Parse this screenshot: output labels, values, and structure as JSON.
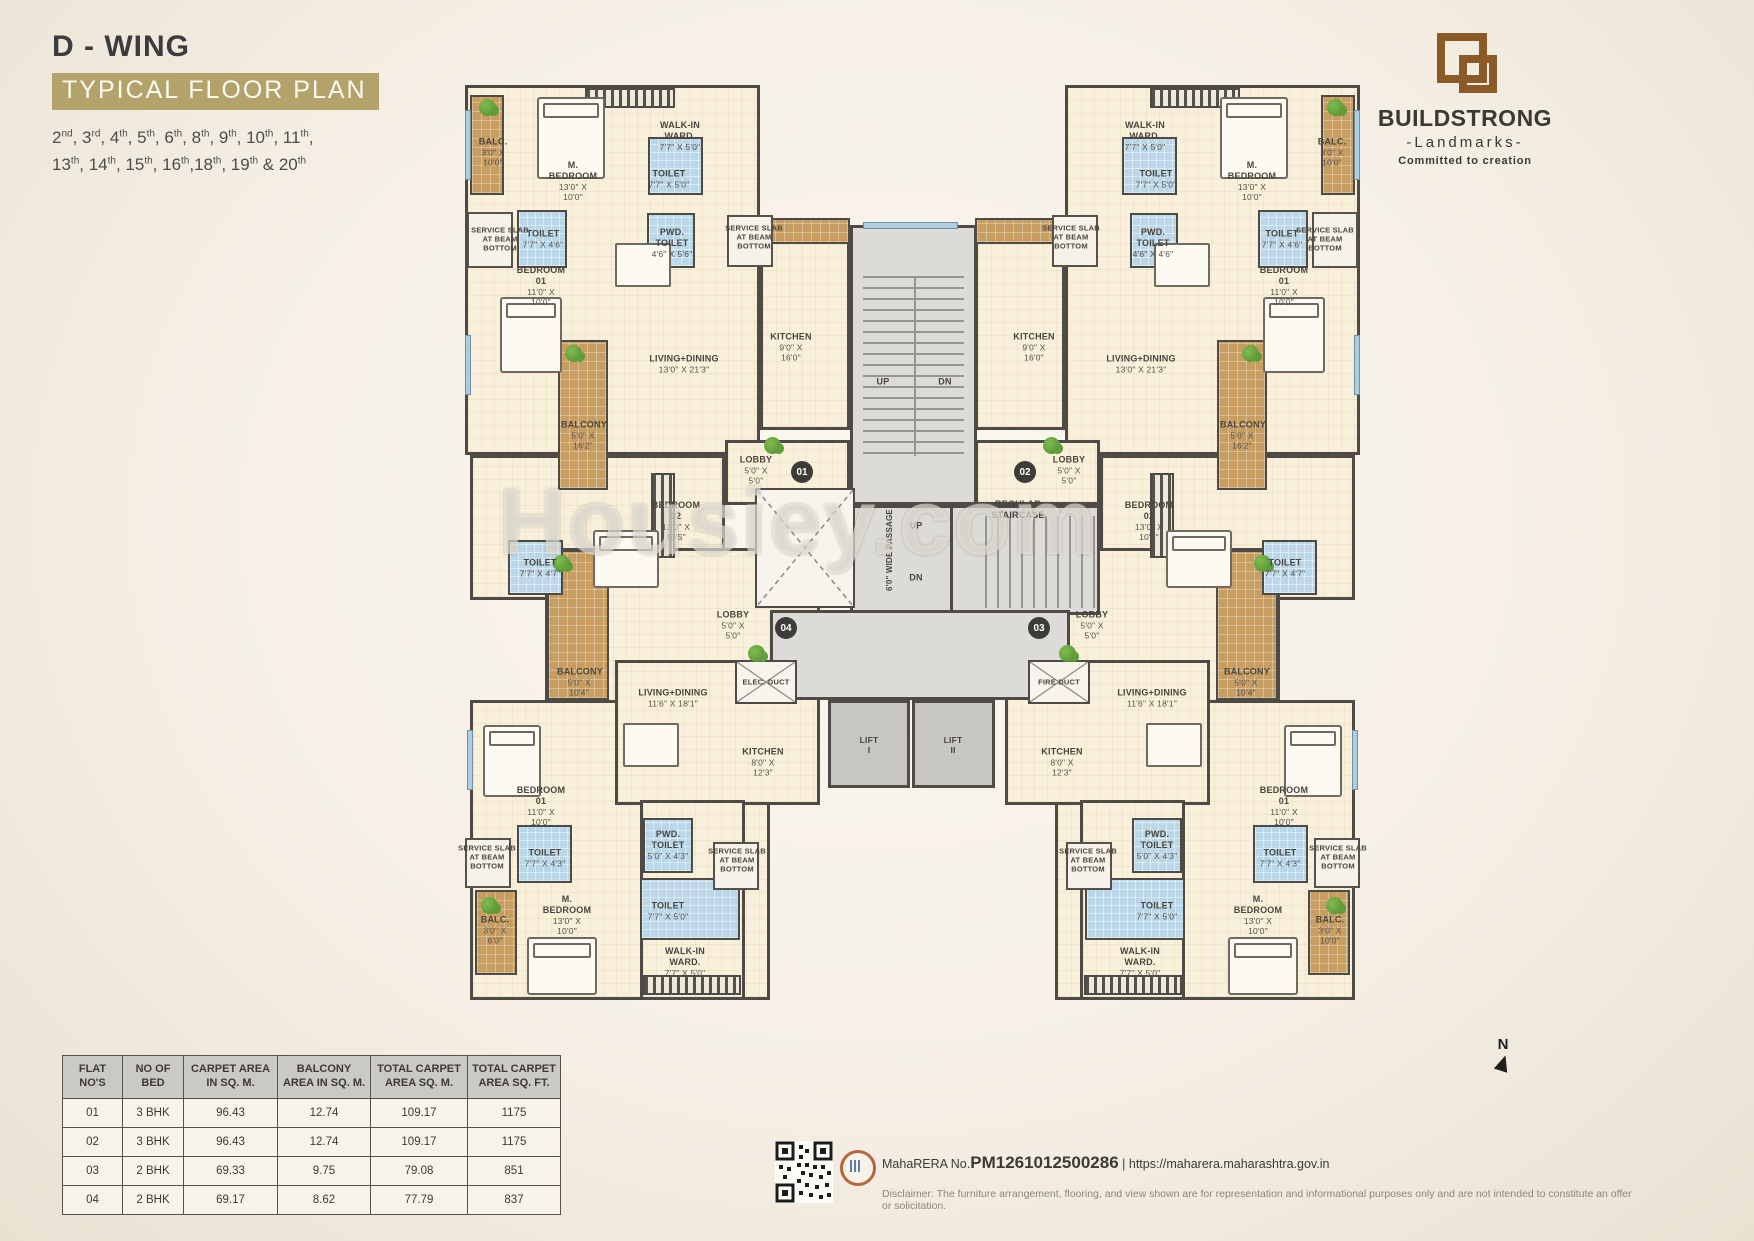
{
  "header": {
    "wing": "D - WING",
    "plan_type": "TYPICAL FLOOR PLAN",
    "floors_line1": "2nd, 3rd, 4th, 5th, 6th, 8th, 9th, 10th, 11th,",
    "floors_line2": "13th, 14th, 15th, 16th,18th, 19th & 20th"
  },
  "brand": {
    "name": "BUILDSTRONG",
    "sub": "-Landmarks-",
    "tagline": "Committed to creation"
  },
  "watermark": "Housiey.com",
  "compass": "N",
  "plan": {
    "labels": [
      {
        "t": "BALC.",
        "d": "3'0\" X 10'0\"",
        "x": 28,
        "y": 67,
        "w": 40
      },
      {
        "t": "M. BEDROOM",
        "d": "13'0\" X 10'0\"",
        "x": 108,
        "y": 96
      },
      {
        "t": "WALK-IN WARD.",
        "d": "7'7\" X 5'0\"",
        "x": 215,
        "y": 51,
        "w": 60
      },
      {
        "t": "TOILET",
        "d": "7'7\" X 5'0\"",
        "x": 204,
        "y": 94,
        "w": 44
      },
      {
        "t": "SERVICE SLAB AT BEAM BOTTOM",
        "x": 35,
        "y": 154,
        "w": 58,
        "s": 7.5
      },
      {
        "t": "TOILET",
        "d": "7'7\" X 4'6\"",
        "x": 78,
        "y": 154,
        "w": 44
      },
      {
        "t": "PWD. TOILET",
        "d": "4'6\" X 5'6\"",
        "x": 207,
        "y": 158,
        "w": 48
      },
      {
        "t": "SERVICE SLAB AT BEAM BOTTOM",
        "x": 289,
        "y": 152,
        "w": 58,
        "s": 7.5
      },
      {
        "t": "BEDROOM 01",
        "d": "11'0\" X 10'0\"",
        "x": 76,
        "y": 201
      },
      {
        "t": "LIVING+DINING",
        "d": "13'0\" X 21'3\"",
        "x": 219,
        "y": 279
      },
      {
        "t": "KITCHEN",
        "d": "9'0\" X 16'0\"",
        "x": 326,
        "y": 262
      },
      {
        "t": "BALCONY",
        "d": "5'0\" X 16'2\"",
        "x": 118,
        "y": 350,
        "w": 44
      },
      {
        "t": "LOBBY",
        "d": "5'0\" X 5'0\"",
        "x": 291,
        "y": 385
      },
      {
        "t": "BEDROOM 02",
        "d": "13'0\" X 10'5\"",
        "x": 211,
        "y": 436
      },
      {
        "t": "TOILET",
        "d": "7'7\" X 4'7\"",
        "x": 75,
        "y": 483,
        "w": 44
      },
      {
        "t": "BALC.",
        "d": "3'0\" X 10'0\"",
        "x": 867,
        "y": 67,
        "w": 40
      },
      {
        "t": "M. BEDROOM",
        "d": "13'0\" X 10'0\"",
        "x": 787,
        "y": 96
      },
      {
        "t": "WALK-IN WARD.",
        "d": "7'7\" X 5'0\"",
        "x": 680,
        "y": 51,
        "w": 60
      },
      {
        "t": "TOILET",
        "d": "7'7\" X 5'0\"",
        "x": 691,
        "y": 94,
        "w": 44
      },
      {
        "t": "SERVICE SLAB AT BEAM BOTTOM",
        "x": 860,
        "y": 154,
        "w": 58,
        "s": 7.5
      },
      {
        "t": "TOILET",
        "d": "7'7\" X 4'6\"",
        "x": 817,
        "y": 154,
        "w": 44
      },
      {
        "t": "PWD. TOILET",
        "d": "4'6\" X 4'6\"",
        "x": 688,
        "y": 158,
        "w": 48
      },
      {
        "t": "SERVICE SLAB AT BEAM BOTTOM",
        "x": 606,
        "y": 152,
        "w": 58,
        "s": 7.5
      },
      {
        "t": "BEDROOM 01",
        "d": "11'0\" X 10'0\"",
        "x": 819,
        "y": 201
      },
      {
        "t": "LIVING+DINING",
        "d": "13'0\" X 21'3\"",
        "x": 676,
        "y": 279
      },
      {
        "t": "KITCHEN",
        "d": "9'0\" X 16'0\"",
        "x": 569,
        "y": 262
      },
      {
        "t": "BALCONY",
        "d": "5'0\" X 16'2\"",
        "x": 777,
        "y": 350,
        "w": 44
      },
      {
        "t": "LOBBY",
        "d": "5'0\" X 5'0\"",
        "x": 604,
        "y": 385
      },
      {
        "t": "BEDROOM 02",
        "d": "13'0\" X 10'5\"",
        "x": 684,
        "y": 436
      },
      {
        "t": "TOILET",
        "d": "7'7\" X 4'7\"",
        "x": 820,
        "y": 483,
        "w": 44
      },
      {
        "t": "LOBBY",
        "d": "5'0\" X 5'0\"",
        "x": 268,
        "y": 540
      },
      {
        "t": "ELEC. DUCT",
        "x": 301,
        "y": 597,
        "w": 70,
        "s": 7.5
      },
      {
        "t": "LIVING+DINING",
        "d": "11'6\" X 18'1\"",
        "x": 208,
        "y": 613
      },
      {
        "t": "BALCONY",
        "d": "5'0\" X 10'4\"",
        "x": 114,
        "y": 597,
        "w": 44
      },
      {
        "t": "BEDROOM 01",
        "d": "11'0\" X 10'0\"",
        "x": 76,
        "y": 721
      },
      {
        "t": "SERVICE SLAB AT BEAM BOTTOM",
        "x": 22,
        "y": 772,
        "w": 58,
        "s": 7.5
      },
      {
        "t": "TOILET",
        "d": "7'7\" X 4'3\"",
        "x": 80,
        "y": 773,
        "w": 44
      },
      {
        "t": "PWD. TOILET",
        "d": "5'0\" X 4'3\"",
        "x": 203,
        "y": 760,
        "w": 48
      },
      {
        "t": "SERVICE SLAB AT BEAM BOTTOM",
        "x": 272,
        "y": 775,
        "w": 58,
        "s": 7.5
      },
      {
        "t": "KITCHEN",
        "d": "8'0\" X 12'3\"",
        "x": 298,
        "y": 677
      },
      {
        "t": "BALC.",
        "d": "3'0\" X 6'0\"",
        "x": 30,
        "y": 845,
        "w": 36
      },
      {
        "t": "M. BEDROOM",
        "d": "13'0\" X 10'0\"",
        "x": 102,
        "y": 830
      },
      {
        "t": "TOILET",
        "d": "7'7\" X 5'0\"",
        "x": 203,
        "y": 826,
        "w": 44
      },
      {
        "t": "WALK-IN WARD.",
        "d": "7'7\" X 5'0\"",
        "x": 220,
        "y": 877,
        "w": 62
      },
      {
        "t": "LOBBY",
        "d": "5'0\" X 5'0\"",
        "x": 627,
        "y": 540
      },
      {
        "t": "FIRE DUCT",
        "x": 594,
        "y": 597,
        "w": 70,
        "s": 7.5
      },
      {
        "t": "LIVING+DINING",
        "d": "11'6\" X 18'1\"",
        "x": 687,
        "y": 613
      },
      {
        "t": "BALCONY",
        "d": "5'0\" X 10'4\"",
        "x": 781,
        "y": 597,
        "w": 44
      },
      {
        "t": "BEDROOM 01",
        "d": "11'0\" X 10'0\"",
        "x": 819,
        "y": 721
      },
      {
        "t": "SERVICE SLAB AT BEAM BOTTOM",
        "x": 873,
        "y": 772,
        "w": 58,
        "s": 7.5
      },
      {
        "t": "TOILET",
        "d": "7'7\" X 4'3\"",
        "x": 815,
        "y": 773,
        "w": 44
      },
      {
        "t": "PWD. TOILET",
        "d": "5'0\" X 4'3\"",
        "x": 692,
        "y": 760,
        "w": 48
      },
      {
        "t": "SERVICE SLAB AT BEAM BOTTOM",
        "x": 623,
        "y": 775,
        "w": 58,
        "s": 7.5
      },
      {
        "t": "KITCHEN",
        "d": "8'0\" X 12'3\"",
        "x": 597,
        "y": 677
      },
      {
        "t": "BALC.",
        "d": "3'0\" X 10'0\"",
        "x": 865,
        "y": 845,
        "w": 36
      },
      {
        "t": "M. BEDROOM",
        "d": "13'0\" X 10'0\"",
        "x": 793,
        "y": 830
      },
      {
        "t": "TOILET",
        "d": "7'7\" X 5'0\"",
        "x": 692,
        "y": 826,
        "w": 44
      },
      {
        "t": "WALK-IN WARD.",
        "d": "7'7\" X 5'0\"",
        "x": 675,
        "y": 877,
        "w": 62
      },
      {
        "t": "UP",
        "x": 418,
        "y": 297,
        "s": 9
      },
      {
        "t": "DN",
        "x": 480,
        "y": 297,
        "s": 9
      },
      {
        "t": "6'0\" WIDE PASSAGE",
        "x": 425,
        "y": 465,
        "r": -90,
        "s": 8,
        "w": 200
      },
      {
        "t": "REGULAR STAIRCASE",
        "x": 553,
        "y": 425,
        "w": 80
      },
      {
        "t": "UP",
        "x": 451,
        "y": 441,
        "s": 9
      },
      {
        "t": "DN",
        "x": 451,
        "y": 493,
        "s": 9
      },
      {
        "t": "LIFT I",
        "x": 404,
        "y": 660,
        "s": 8.5
      },
      {
        "t": "LIFT II",
        "x": 488,
        "y": 660,
        "s": 8.5
      }
    ],
    "badges": [
      {
        "n": "01",
        "x": 337,
        "y": 387
      },
      {
        "n": "02",
        "x": 560,
        "y": 387
      },
      {
        "n": "03",
        "x": 574,
        "y": 543
      },
      {
        "n": "04",
        "x": 321,
        "y": 543
      }
    ]
  },
  "area_table": {
    "headers": [
      "FLAT NO'S",
      "NO OF BED",
      "CARPET AREA IN SQ. M.",
      "BALCONY AREA IN SQ. M.",
      "TOTAL CARPET AREA SQ. M.",
      "TOTAL CARPET AREA SQ. FT."
    ],
    "rows": [
      [
        "01",
        "3 BHK",
        "96.43",
        "12.74",
        "109.17",
        "1175"
      ],
      [
        "02",
        "3 BHK",
        "96.43",
        "12.74",
        "109.17",
        "1175"
      ],
      [
        "03",
        "2 BHK",
        "69.33",
        "9.75",
        "79.08",
        "851"
      ],
      [
        "04",
        "2 BHK",
        "69.17",
        "8.62",
        "77.79",
        "837"
      ]
    ]
  },
  "footer": {
    "rera_prefix": "MahaRERA No.",
    "rera_number": "PM1261012500286",
    "separator": "|",
    "rera_url": "https://maharera.maharashtra.gov.in",
    "disclaimer": "Disclaimer: The furniture arrangement, flooring, and view shown are for representation and informational purposes only and are not intended to constitute an offer or solicitation."
  }
}
